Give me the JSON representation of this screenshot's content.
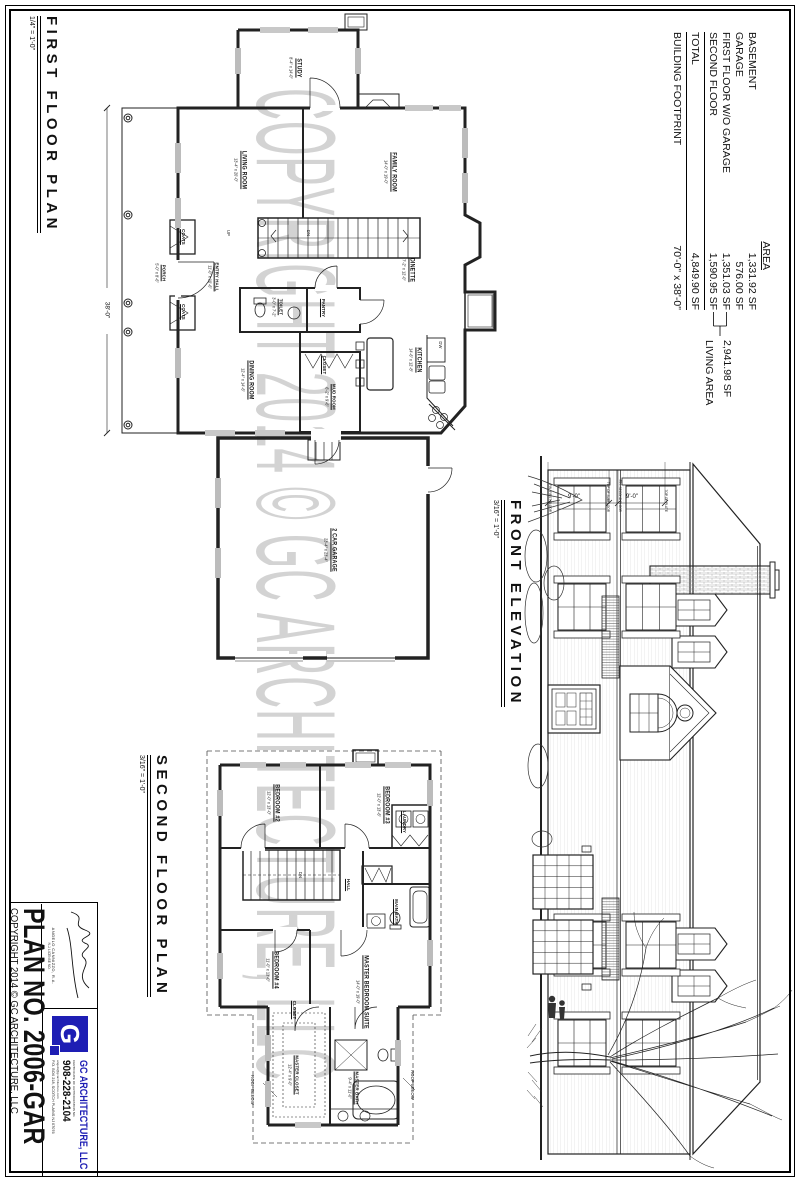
{
  "sheet_titles": {
    "first_floor": {
      "label": "FIRST FLOOR PLAN",
      "scale": "1/4\" = 1'-0\""
    },
    "front_elevation": {
      "label": "FRONT ELEVATION",
      "scale": "3/16\" = 1'-0\""
    },
    "second_floor": {
      "label": "SECOND FLOOR PLAN",
      "scale": "3/16\" = 1'-0\""
    }
  },
  "area_table": {
    "header": "AREA",
    "rows": [
      {
        "label": "BASEMENT",
        "value": "1,331.92 SF"
      },
      {
        "label": "GARAGE",
        "value": "576.00 SF"
      },
      {
        "label": "FIRST FLOOR W/O GARAGE",
        "value": "1,351.03 SF"
      },
      {
        "label": "SECOND FLOOR",
        "value": "1,590.95 SF"
      }
    ],
    "total": {
      "label": "TOTAL",
      "value": "4,849.90 SF"
    },
    "footprint": {
      "label": "BUILDING FOOTPRINT",
      "value": "70'-0\" x 38'-0\""
    },
    "living_area": {
      "value": "2,941.98 SF",
      "label": "LIVING AREA"
    }
  },
  "title_block": {
    "plan_no": "PLAN NO. 2006-GAR",
    "copyright": "COPYRIGHT 2014 © GC ARCHITECTURE, LLC",
    "architect": "ANGELO CANNIZZO, R.A.",
    "license": "N.J. LICENSE NO.",
    "logo_letter": "G",
    "firm": "GC ARCHITECTURE, LLC",
    "cert": "CERTIFICATE OF AUTHORIZATION NO.",
    "phone": "908-228-2104",
    "email": "angelo@gcarchitecture.com",
    "address": "P.O. BOX 218, SCOTCH PLAINS NJ 07076"
  },
  "watermark": "COPYRIGHT 2014 © GC ARCHITECTURE, LLC",
  "first_floor_rooms": [
    {
      "label": "STUDY",
      "dims": "8'-4\" x 14'-0\""
    },
    {
      "label": "LIVING ROOM",
      "dims": "13'-4\" x 20'-0\""
    },
    {
      "label": "FAMILY ROOM",
      "dims": "14'-0\" x 19'-0\""
    },
    {
      "label": "PORCH",
      "dims": "5'-0\" x 8'-6\""
    },
    {
      "label": "ENTRY HALL",
      "dims": "11'-0\" x 10'-6\""
    },
    {
      "label": "COATS"
    },
    {
      "label": "COATS"
    },
    {
      "label": "TOILET",
      "dims": "3'-0\" x 7'-2\""
    },
    {
      "label": "PANTRY"
    },
    {
      "label": "DINING ROOM",
      "dims": "12'-4\" x 14'-6\""
    },
    {
      "label": "CLOSET"
    },
    {
      "label": "MUD ROOM",
      "dims": "6'-2\" x 9'-6\""
    },
    {
      "label": "DINETTE",
      "dims": "7'-2\" x 12'-0\""
    },
    {
      "label": "KITCHEN",
      "dims": "14'-6\" x 12'-8\""
    },
    {
      "label": "DW"
    },
    {
      "label": "UP"
    },
    {
      "label": "DN"
    },
    {
      "label": "2 CAR GARAGE",
      "dims": "23'-4\" x 23'-4\""
    }
  ],
  "second_floor_rooms": [
    {
      "label": "BEDROOM #2",
      "dims": "12'-0\" x 13'-0\""
    },
    {
      "label": "BEDROOM #3",
      "dims": "12'-0\" x 13'-6\""
    },
    {
      "label": "LAUNDRY"
    },
    {
      "label": "HALL"
    },
    {
      "label": "MAIN BATH"
    },
    {
      "label": "CLOSET"
    },
    {
      "label": "BEDROOM #4",
      "dims": "11'-0\" x 13'-0\""
    },
    {
      "label": "MASTER BEDROOM SUITE",
      "dims": "14'-0\" x 19'-0\""
    },
    {
      "label": "MASTER CLOSET",
      "dims": "12'-4\" x 9'-0\""
    },
    {
      "label": "MASTER BATH",
      "dims": "9'-4\" x 11'-0\""
    },
    {
      "label": "ROOF BELOW"
    },
    {
      "label": "ROOF BELOW"
    },
    {
      "label": "DN"
    }
  ],
  "elevation": {
    "dim1": "9'-0\"",
    "dim2": "9'-0\"",
    "levels": [
      "TOP OF PLATE",
      "FIN. SECOND FLOOR",
      "TOP OF SUBFLOOR",
      "FIN. FIRST FLOOR"
    ],
    "plan_dim": "38'-0\""
  },
  "colors": {
    "brand_blue": "#1e1eb4",
    "line": "#222222",
    "watermark_gray": "#c9c9c9"
  }
}
